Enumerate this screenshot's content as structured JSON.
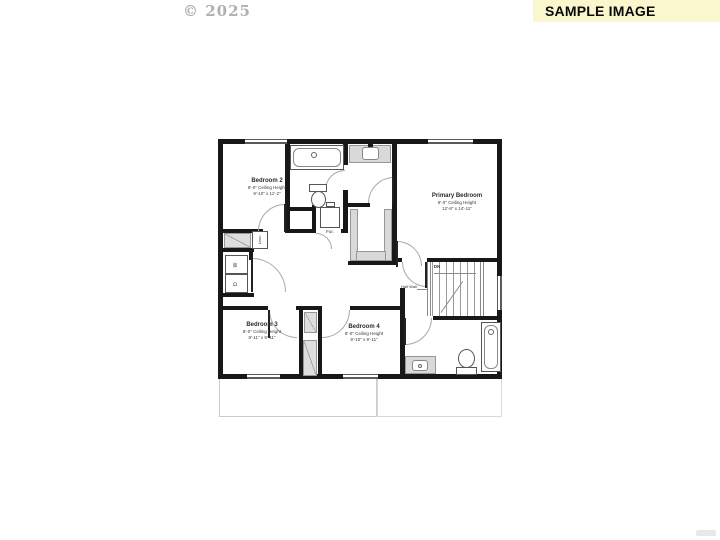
{
  "watermark": {
    "text": "© 2025"
  },
  "banner": {
    "text": "SAMPLE IMAGE",
    "bg": "#FAF7CF",
    "text_color": "#0a0a0a"
  },
  "floorplan": {
    "rooms": [
      {
        "name": "Bedroom 2",
        "ceiling": "8'-0\" Ceiling Height",
        "dims": "9'-10\" x 11'-2\""
      },
      {
        "name": "Primary Bedroom",
        "ceiling": "8'-0\" Ceiling Height",
        "dims": "12'-8\" x 14'-11\""
      },
      {
        "name": "Bedroom 3",
        "ceiling": "8'-0\" Ceiling Height",
        "dims": "9'-11\" x 9'-11\""
      },
      {
        "name": "Bedroom 4",
        "ceiling": "8'-0\" Ceiling Height",
        "dims": "9'-10\" x 9'-11\""
      }
    ],
    "labels": {
      "stairs_down": "DN",
      "half_wall": "Half Wall",
      "furnace": "Fur.",
      "washer": "W",
      "dryer": "D",
      "linen": "Linen"
    },
    "colors": {
      "wall": "#181818",
      "counter_gray": "#d9d9d9"
    }
  }
}
